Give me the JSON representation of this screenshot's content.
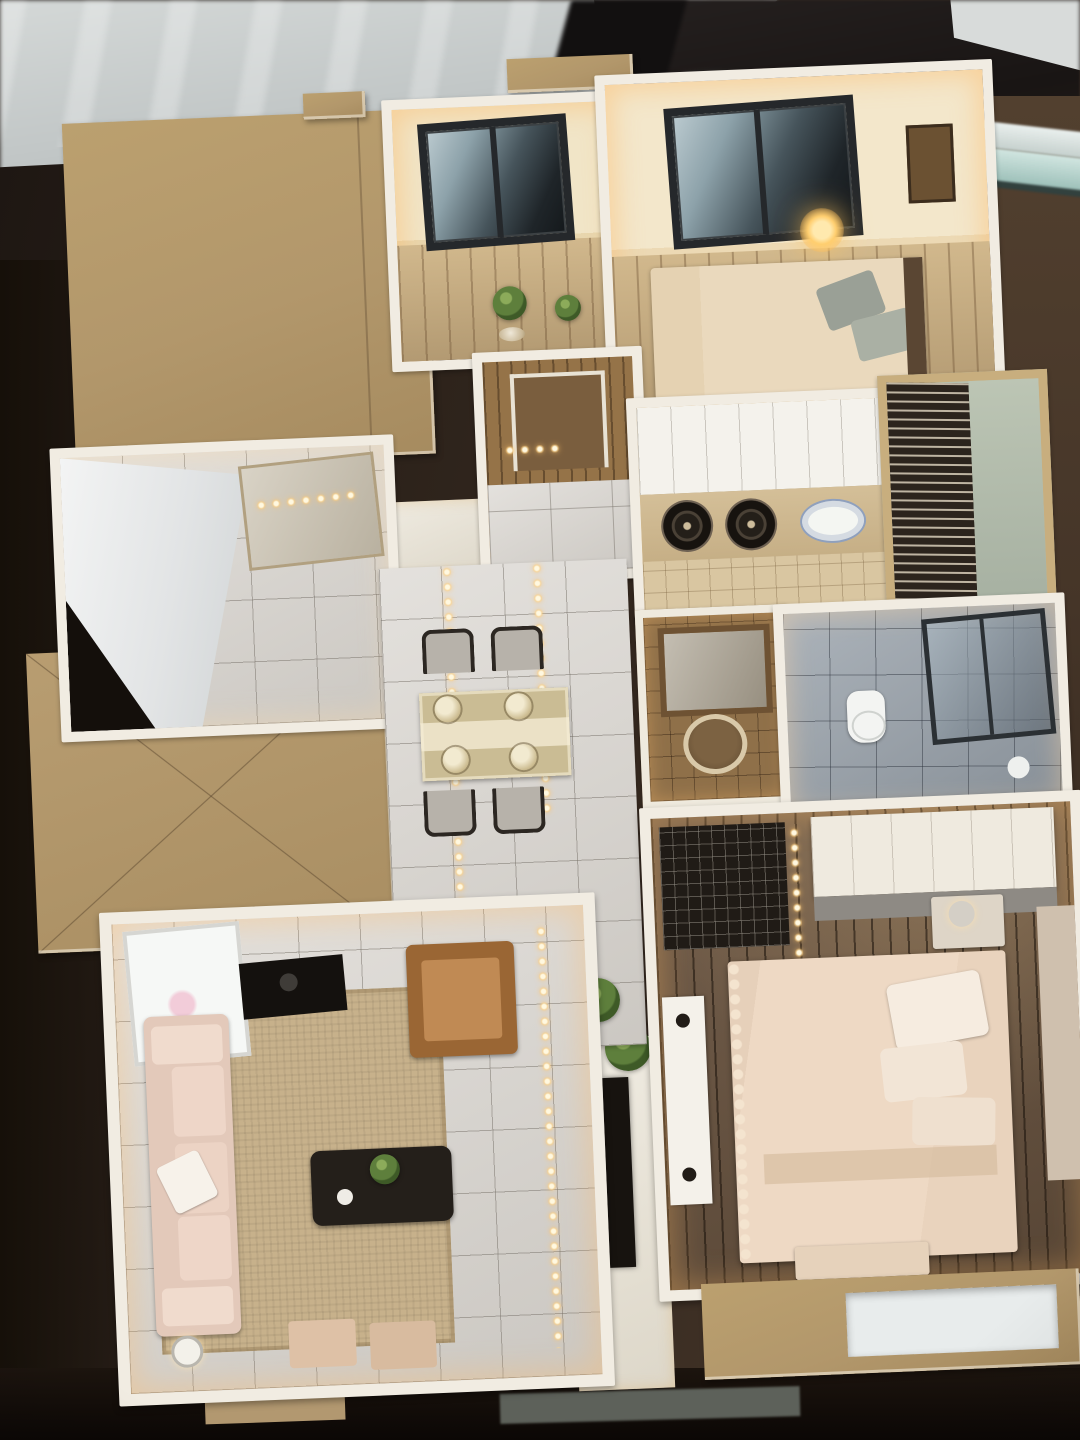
{
  "scene": {
    "type": "photograph",
    "subject": "Miniature apartment floor-plan scale model, viewed from above, displayed on a dark wood table in a sales gallery",
    "lighting": "warm interior LED strips and dot lights inside the model"
  },
  "palette": {
    "table_wood": "#3a2d23",
    "showroom_floor": "#c9cdcd",
    "glass_edge_teal": "#a9c9c2",
    "roof_tan": "#b2976b",
    "wall_white": "#f1ece2",
    "warm_light": "#ffc878",
    "marble_tile": "#d8d4ce",
    "light_wood_floor": "#c2a77c",
    "dark_wood_floor": "#6b5541",
    "sofa_pink": "#ecd3c6",
    "armchair_brown": "#9a6634",
    "lattice_screen": "#2c241d",
    "bath_tile_gray": "#97a0a9"
  },
  "rooms": [
    {
      "id": "roof-panel-main",
      "title": "Tan roof panel (closed area)"
    },
    {
      "id": "study-room",
      "title": "Study room with window and plants"
    },
    {
      "id": "bedroom-secondary",
      "title": "Secondary bedroom with lit lamp and bed"
    },
    {
      "id": "entry-hall",
      "title": "Entry hall with wood door"
    },
    {
      "id": "foyer-closet-room",
      "title": "Foyer room with mirrored wardrobe"
    },
    {
      "id": "roof-panel-x",
      "title": "Tan roof panel with X seam"
    },
    {
      "id": "kitchen",
      "title": "Kitchen with two burners and plate"
    },
    {
      "id": "laundry-balcony",
      "title": "Service balcony with lattice screen"
    },
    {
      "id": "vanity-washroom",
      "title": "Vanity area with round basin and mirror"
    },
    {
      "id": "bathroom",
      "title": "Bathroom with toilet and glass shower"
    },
    {
      "id": "dining-area",
      "title": "Dining area with set table and four chairs"
    },
    {
      "id": "living-room",
      "title": "Living room with sofa, TV wall and coffee table"
    },
    {
      "id": "master-bedroom",
      "title": "Master bedroom with large bed and wardrobe"
    }
  ],
  "furniture_counts": {
    "dining_chairs": 4,
    "stove_burners": 2,
    "beds": 2,
    "sofas": 1,
    "ottomans": 2,
    "potted_plants": 5
  }
}
